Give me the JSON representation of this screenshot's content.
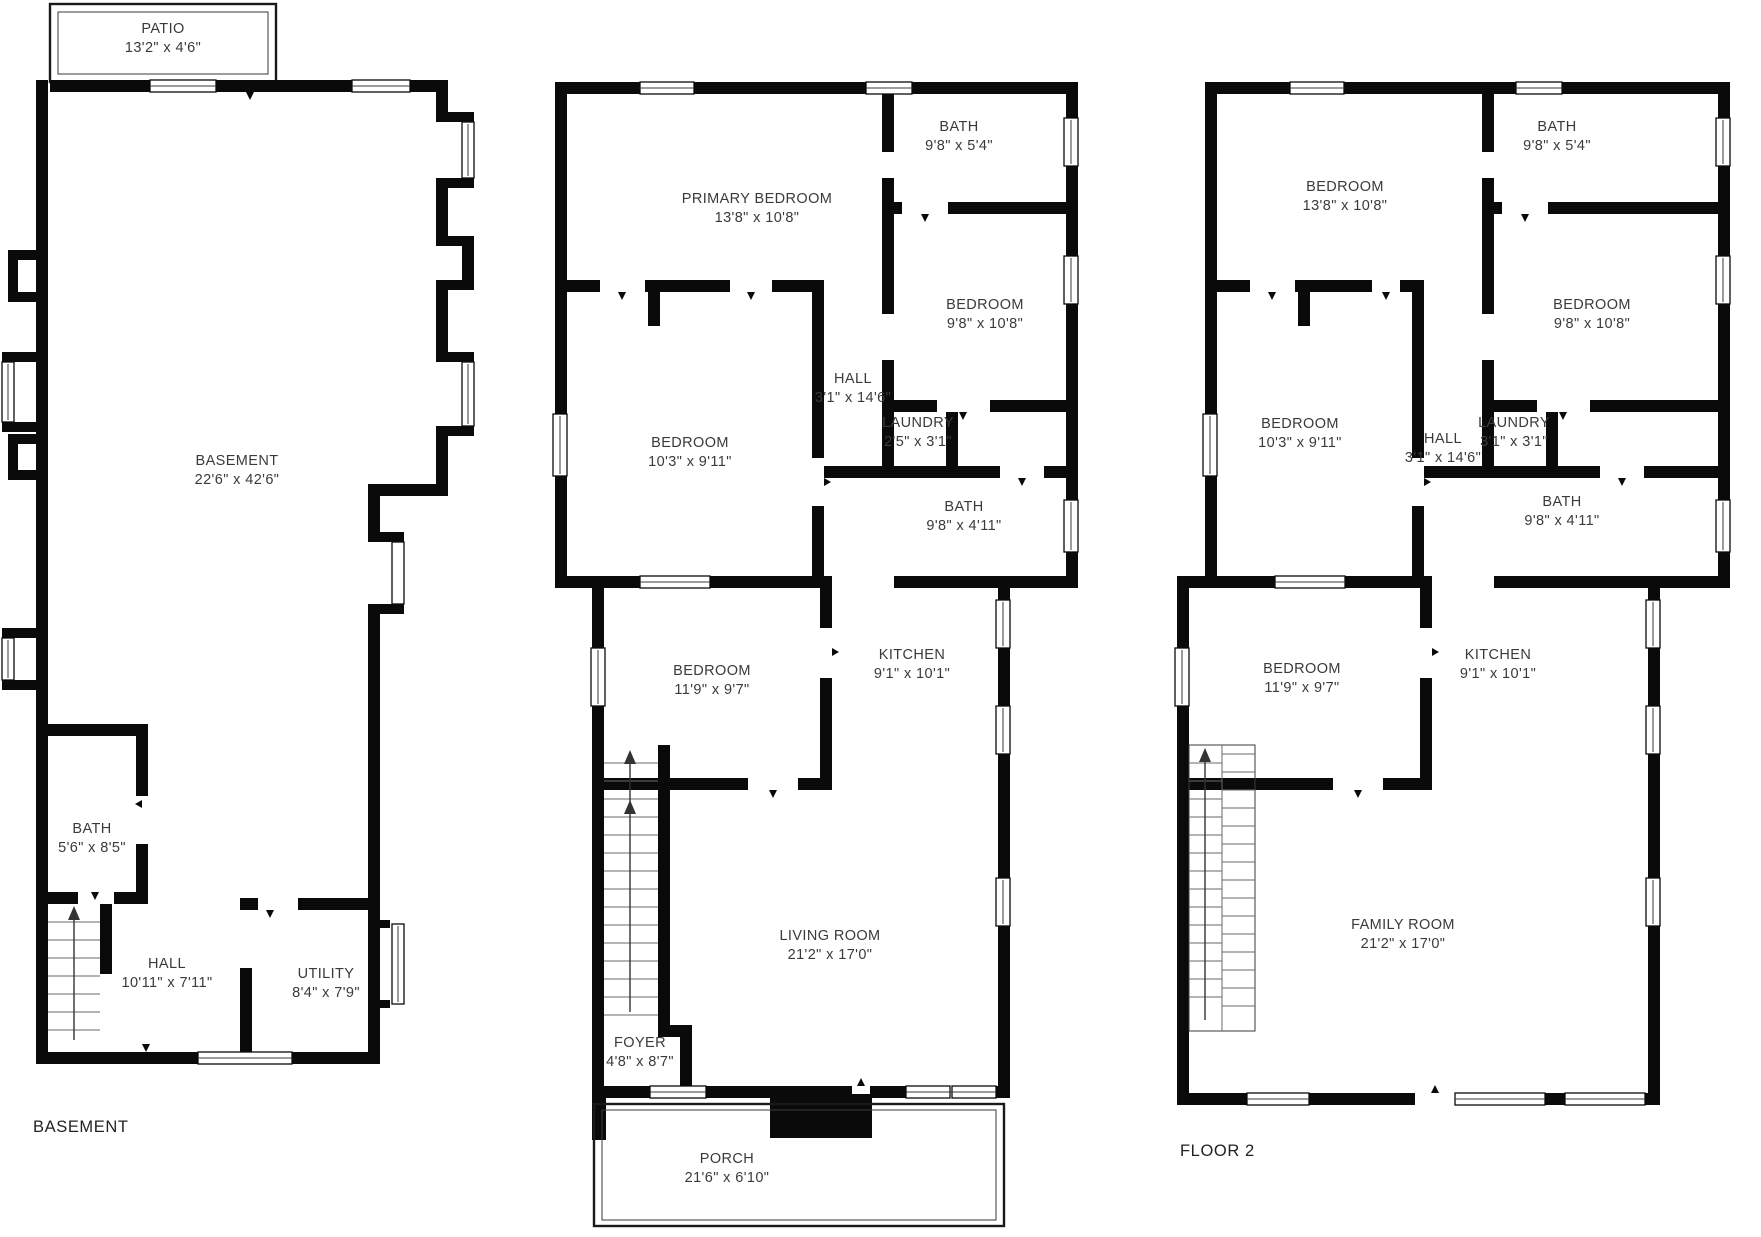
{
  "page": {
    "background": "#ffffff",
    "wall_color": "#0a0a0a",
    "text_color": "#3a3a3a"
  },
  "plans": {
    "basement": {
      "caption": "BASEMENT",
      "rooms": {
        "patio": {
          "name": "PATIO",
          "dims": "13'2\" x 4'6\""
        },
        "basement": {
          "name": "BASEMENT",
          "dims": "22'6\" x 42'6\""
        },
        "bath": {
          "name": "BATH",
          "dims": "5'6\" x 8'5\""
        },
        "hall": {
          "name": "HALL",
          "dims": "10'11\" x 7'11\""
        },
        "utility": {
          "name": "UTILITY",
          "dims": "8'4\" x 7'9\""
        }
      }
    },
    "floor1": {
      "rooms": {
        "primary_bedroom": {
          "name": "PRIMARY BEDROOM",
          "dims": "13'8\" x 10'8\""
        },
        "bath_upper": {
          "name": "BATH",
          "dims": "9'8\" x 5'4\""
        },
        "bedroom_upper": {
          "name": "BEDROOM",
          "dims": "9'8\" x 10'8\""
        },
        "hall": {
          "name": "HALL",
          "dims": "3'1\" x 14'6\""
        },
        "laundry": {
          "name": "LAUNDRY",
          "dims": "2'5\" x 3'1\""
        },
        "bedroom_mid": {
          "name": "BEDROOM",
          "dims": "10'3\" x 9'11\""
        },
        "bath_lower": {
          "name": "BATH",
          "dims": "9'8\" x 4'11\""
        },
        "bedroom_lower": {
          "name": "BEDROOM",
          "dims": "11'9\" x 9'7\""
        },
        "kitchen": {
          "name": "KITCHEN",
          "dims": "9'1\" x 10'1\""
        },
        "living_room": {
          "name": "LIVING ROOM",
          "dims": "21'2\" x 17'0\""
        },
        "foyer": {
          "name": "FOYER",
          "dims": "4'8\" x 8'7\""
        },
        "porch": {
          "name": "PORCH",
          "dims": "21'6\" x 6'10\""
        }
      }
    },
    "floor2": {
      "caption": "FLOOR 2",
      "rooms": {
        "bedroom_upper_left": {
          "name": "BEDROOM",
          "dims": "13'8\" x 10'8\""
        },
        "bath_upper": {
          "name": "BATH",
          "dims": "9'8\" x 5'4\""
        },
        "bedroom_upper_right": {
          "name": "BEDROOM",
          "dims": "9'8\" x 10'8\""
        },
        "bedroom_mid": {
          "name": "BEDROOM",
          "dims": "10'3\" x 9'11\""
        },
        "hall": {
          "name": "HALL",
          "dims": "3'1\" x 14'6\""
        },
        "laundry": {
          "name": "LAUNDRY",
          "dims": "3'1\" x 3'1\""
        },
        "bath_lower": {
          "name": "BATH",
          "dims": "9'8\" x 4'11\""
        },
        "bedroom_lower": {
          "name": "BEDROOM",
          "dims": "11'9\" x 9'7\""
        },
        "kitchen": {
          "name": "KITCHEN",
          "dims": "9'1\" x 10'1\""
        },
        "family_room": {
          "name": "FAMILY ROOM",
          "dims": "21'2\" x 17'0\""
        }
      }
    }
  }
}
